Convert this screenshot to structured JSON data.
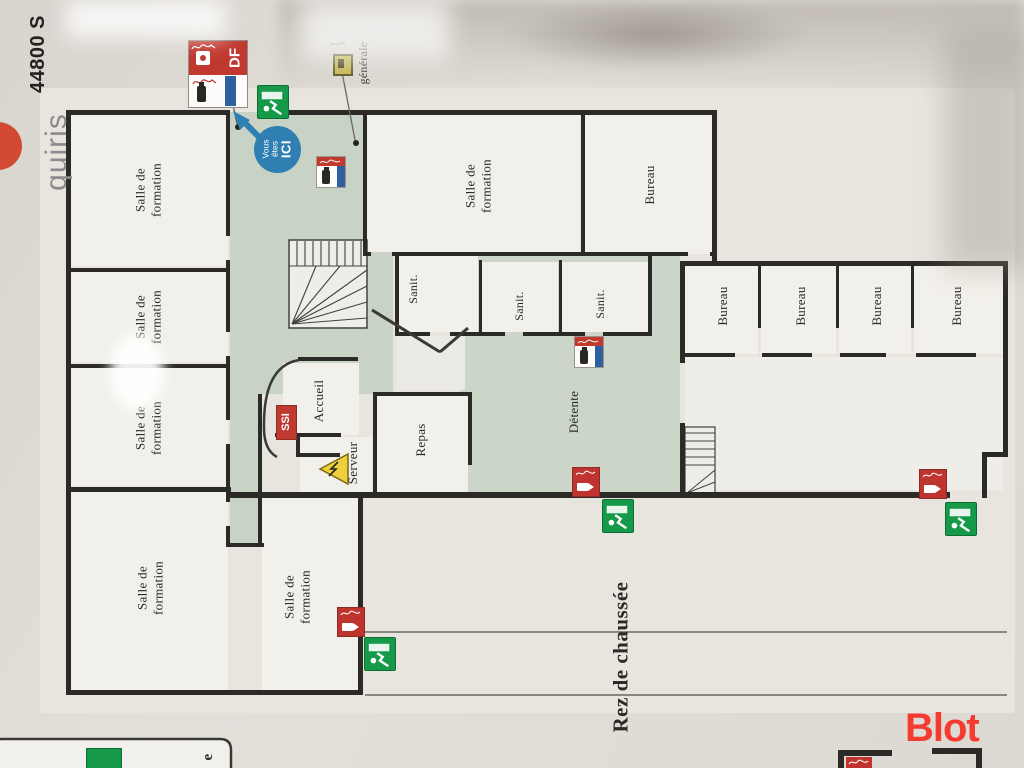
{
  "meta": {
    "watermark": "Blot"
  },
  "brand": {
    "postal": "44800 S",
    "name": "quiris"
  },
  "plan": {
    "floor_label": "Rez de chaussée",
    "legend_fragment": "e",
    "marker": {
      "line1": "Vous êtes",
      "line2": "ICI"
    },
    "tags": {
      "df": "DF",
      "ssi": "SSI",
      "generale": "générale"
    },
    "rooms": [
      {
        "label": "Salle de formation"
      },
      {
        "label": "Salle de formation"
      },
      {
        "label": "Salle de formation"
      },
      {
        "label": "Salle de formation"
      },
      {
        "label": "Salle de formation"
      },
      {
        "label": "Salle de formation"
      },
      {
        "label": "Bureau"
      },
      {
        "label": "Bureau"
      },
      {
        "label": "Bureau"
      },
      {
        "label": "Bureau"
      },
      {
        "label": "Bureau"
      },
      {
        "label": "Sanit."
      },
      {
        "label": "Sanit."
      },
      {
        "label": "Sanit."
      },
      {
        "label": "Détente"
      },
      {
        "label": "Accueil"
      },
      {
        "label": "Serveur"
      },
      {
        "label": "Repas"
      }
    ]
  },
  "colors": {
    "exit_green": "#169a4a",
    "alarm_red": "#bf342e",
    "extinguisher_red": "#c03a2e",
    "band_blue": "#2e5f9e",
    "corridor_green": "#c9d3c5",
    "marker_blue": "#2f7fb3",
    "watermark_red": "#f43a31"
  }
}
